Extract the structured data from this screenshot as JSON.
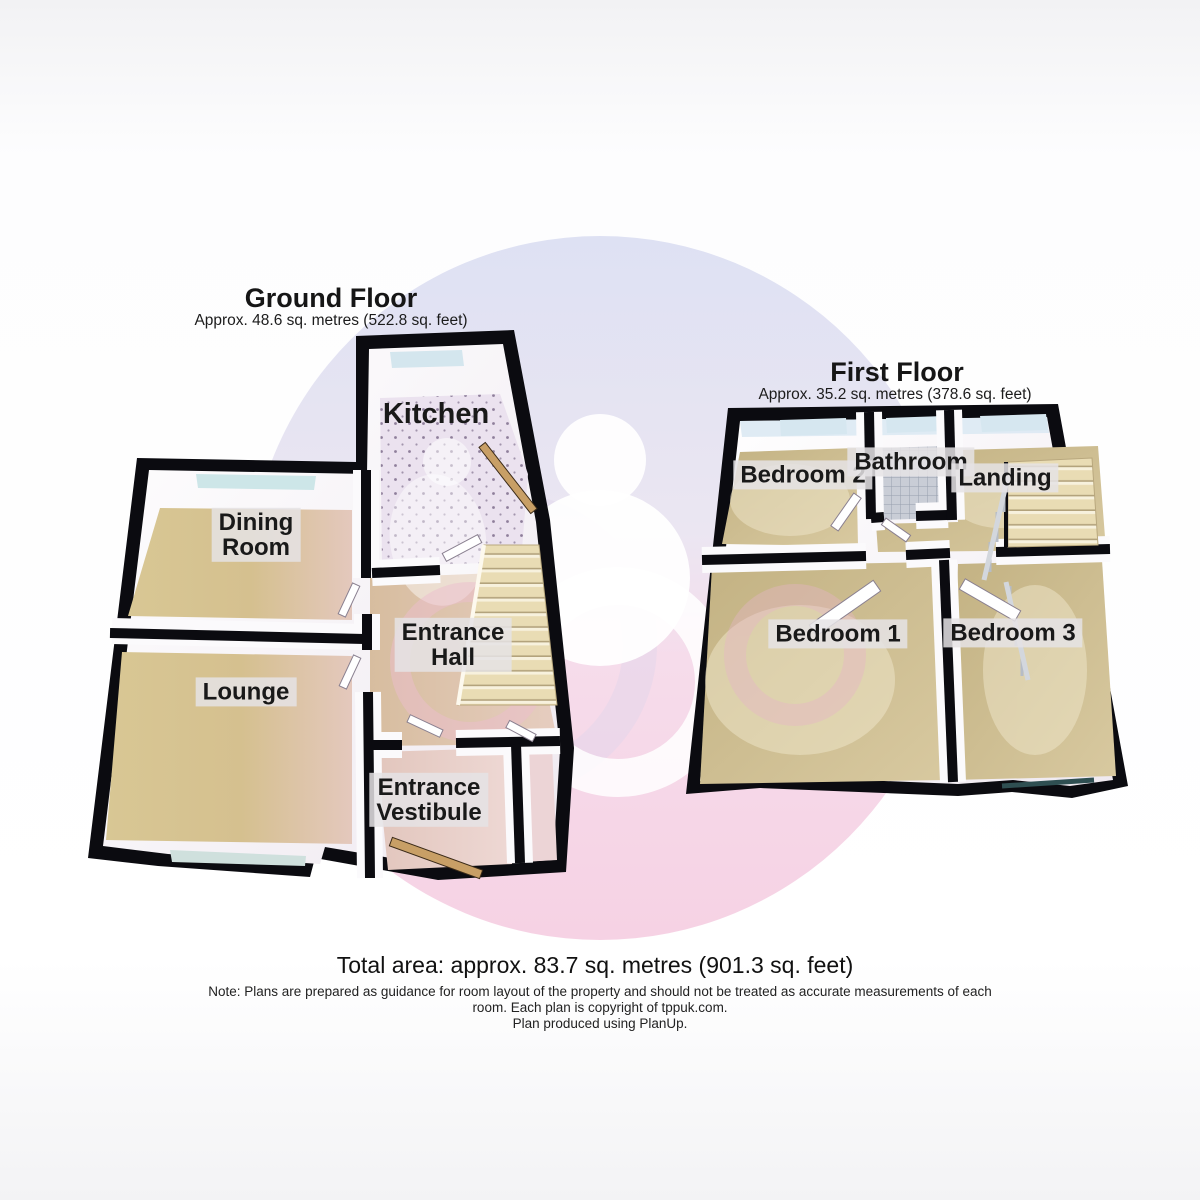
{
  "ground_floor": {
    "title": "Ground Floor",
    "area": "Approx. 48.6 sq. metres (522.8 sq. feet)",
    "rooms": {
      "kitchen": {
        "name": "Kitchen",
        "label": "Kitchen"
      },
      "dining_room": {
        "name": "Dining Room",
        "label": "Dining\nRoom"
      },
      "lounge": {
        "name": "Lounge",
        "label": "Lounge"
      },
      "entrance_hall": {
        "name": "Entrance Hall",
        "label": "Entrance\nHall"
      },
      "entrance_vestibule": {
        "name": "Entrance Vestibule",
        "label": "Entrance\nVestibule"
      }
    }
  },
  "first_floor": {
    "title": "First Floor",
    "area": "Approx. 35.2 sq. metres (378.6 sq. feet)",
    "rooms": {
      "bedroom_2": {
        "name": "Bedroom 2",
        "label": "Bedroom 2"
      },
      "bathroom": {
        "name": "Bathroom",
        "label": "Bathroom"
      },
      "landing": {
        "name": "Landing",
        "label": "Landing"
      },
      "bedroom_1": {
        "name": "Bedroom 1",
        "label": "Bedroom 1"
      },
      "bedroom_3": {
        "name": "Bedroom 3",
        "label": "Bedroom 3"
      }
    }
  },
  "footer": {
    "total_area": "Total area: approx. 83.7 sq. metres (901.3 sq. feet)",
    "note_lines": [
      "Note: Plans are prepared as guidance for room layout of the property and should not be treated as accurate measurements of each",
      "room. Each plan is copyright of tppuk.com.",
      "Plan produced using PlanUp."
    ]
  },
  "colors": {
    "wall": "#0b0b10",
    "floor_tan": "#d5c292",
    "hall_floor": "#dcc3a6",
    "vestibule_floor": "#e8cfc9",
    "kitchen_floor": "#ebe2ef",
    "bathroom_tile": "#c9cdd6",
    "window_glass": "#cde6e8",
    "stair_tread": "#e9dcb4",
    "watermark_top": "#dee1f3",
    "watermark_bottom": "#f6d2e4",
    "label_chip": "#e5e3e5"
  }
}
